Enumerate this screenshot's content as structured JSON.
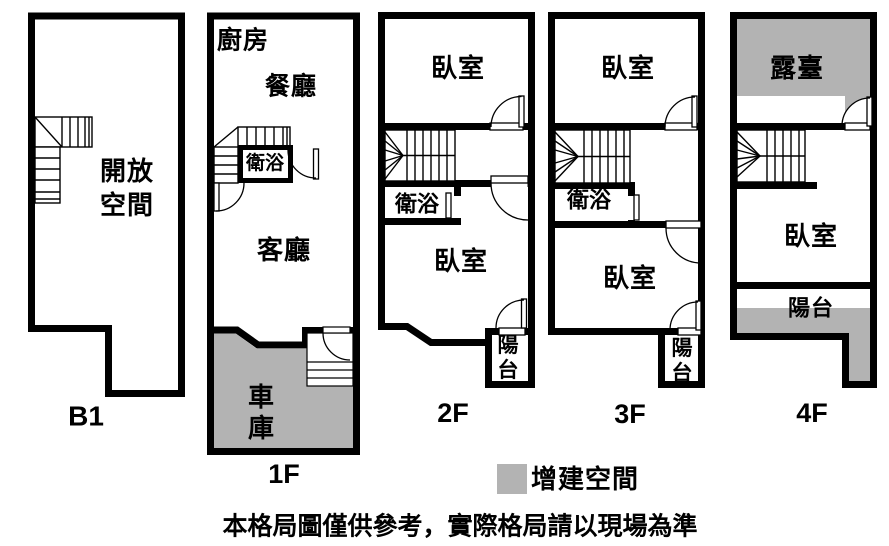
{
  "colors": {
    "wall": "#000000",
    "background": "#ffffff",
    "expansion_fill": "#b3b3b3"
  },
  "floors": {
    "b1": {
      "label": "B1",
      "open_space": "開放空間"
    },
    "f1": {
      "label": "1F",
      "kitchen": "廚房",
      "dining": "餐廳",
      "bathroom": "衛浴",
      "living": "客廳",
      "garage": "車庫"
    },
    "f2": {
      "label": "2F",
      "bedroom_top": "臥室",
      "bathroom": "衛浴",
      "bedroom_bottom": "臥室",
      "balcony": "陽台"
    },
    "f3": {
      "label": "3F",
      "bedroom_top": "臥室",
      "bathroom": "衛浴",
      "bedroom_bottom": "臥室",
      "balcony": "陽台"
    },
    "f4": {
      "label": "4F",
      "terrace": "露臺",
      "bedroom": "臥室",
      "balcony": "陽台"
    }
  },
  "legend": {
    "label": "增建空間",
    "swatch_color": "#b3b3b3"
  },
  "disclaimer": "本格局圖僅供參考，實際格局請以現場為準"
}
